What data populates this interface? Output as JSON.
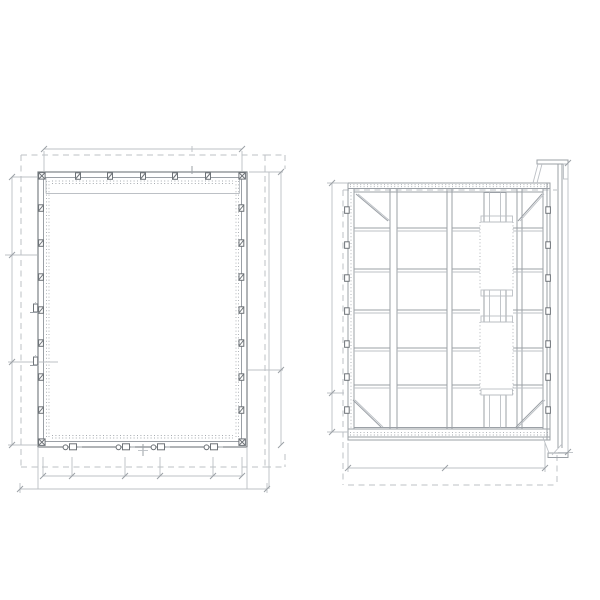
{
  "drawing": {
    "kind": "technical-panel-drawing",
    "views": [
      {
        "id": "front-elevation",
        "description": "panel front elevation with clearance box and dimension lines"
      },
      {
        "id": "rear-framing",
        "description": "panel rear framing view with stiffeners, braces and mounting rail"
      }
    ]
  },
  "colors": {
    "background": "#ffffff",
    "line_medium": "#9ba0a6",
    "line_dark": "#7d8287",
    "line_light": "#bcc0c5",
    "line_dashed": "#bdc1c5",
    "line_dotted": "#a6abb0",
    "hardware": "#6e7378"
  },
  "front": {
    "dashed": [
      [
        21,
        155,
        265,
        155
      ],
      [
        21,
        155,
        21,
        467
      ],
      [
        21,
        467,
        265,
        467
      ],
      [
        265,
        155,
        265,
        467
      ],
      [
        265,
        155,
        285,
        155
      ],
      [
        285,
        155,
        285,
        169
      ],
      [
        265,
        467,
        285,
        467
      ],
      [
        285,
        454,
        285,
        467
      ]
    ],
    "rects": [
      [
        38,
        172,
        209,
        275,
        "dk"
      ],
      [
        43.5,
        177.5,
        198,
        264,
        "ln"
      ]
    ],
    "lines": [
      [
        46,
        193.5,
        239.5,
        193.5,
        "lt"
      ],
      [
        46,
        178,
        46,
        193.5,
        "lt"
      ],
      [
        239.5,
        178,
        239.5,
        193.5,
        "lt"
      ],
      [
        192,
        166,
        192,
        174,
        "ln"
      ],
      [
        143,
        444,
        143,
        456,
        "ln"
      ],
      [
        138,
        450.5,
        148,
        450.5,
        "lt"
      ]
    ],
    "dotted": [
      [
        46.5,
        181,
        46.5,
        438
      ],
      [
        49,
        181,
        49,
        438
      ],
      [
        236,
        181,
        236,
        438
      ],
      [
        238.5,
        181,
        238.5,
        438
      ],
      [
        52,
        181,
        233,
        181
      ],
      [
        52,
        183.5,
        233,
        183.5
      ],
      [
        52,
        435.5,
        233,
        435.5
      ],
      [
        52,
        438,
        233,
        438
      ]
    ],
    "dim_lines": [
      [
        44,
        149,
        242,
        149
      ],
      [
        44,
        151,
        44,
        171
      ],
      [
        242,
        151,
        242,
        171
      ],
      [
        192,
        146,
        192,
        152
      ],
      [
        12,
        177,
        12,
        445
      ],
      [
        12,
        177,
        37,
        177
      ],
      [
        5,
        255,
        37,
        255
      ],
      [
        8,
        362,
        58,
        362
      ],
      [
        8,
        445,
        37,
        445
      ],
      [
        281,
        172,
        281,
        445
      ],
      [
        249,
        172,
        283,
        172
      ],
      [
        248,
        370,
        283,
        370
      ],
      [
        269,
        172,
        269,
        489
      ],
      [
        43,
        476,
        242,
        476
      ],
      [
        20,
        489,
        267,
        489
      ],
      [
        38,
        447,
        38,
        489
      ],
      [
        247,
        447,
        247,
        489
      ],
      [
        20,
        483,
        20,
        493
      ],
      [
        267,
        483,
        267,
        493
      ]
    ],
    "row1_ticks_x": [
      43,
      72,
      125,
      160,
      213,
      242
    ],
    "row1_tick_y": [
      457,
      476
    ],
    "slashes": [
      [
        44,
        149
      ],
      [
        242,
        149
      ],
      [
        12,
        177
      ],
      [
        12,
        255
      ],
      [
        12,
        362
      ],
      [
        12,
        445
      ],
      [
        281,
        172
      ],
      [
        281,
        370
      ],
      [
        281,
        445
      ],
      [
        20,
        489
      ],
      [
        267,
        489
      ]
    ],
    "top_clips_x": [
      78,
      110,
      143,
      175,
      208
    ],
    "side_clips_y": [
      208,
      243,
      277,
      310,
      343,
      377,
      410
    ],
    "corner_clips": [
      [
        38.6,
        172.6
      ],
      [
        238.9,
        172.6
      ],
      [
        38.6,
        438.9
      ],
      [
        238.9,
        438.9
      ]
    ],
    "hardware_x": [
      72,
      125,
      160,
      213
    ],
    "latches_y": [
      304,
      357
    ]
  },
  "side": {
    "dashed": [
      [
        343,
        190,
        557,
        190
      ],
      [
        343,
        190,
        343,
        485
      ],
      [
        348,
        485,
        557,
        485
      ],
      [
        557,
        455,
        557,
        485
      ]
    ],
    "rects": [
      [
        348,
        183,
        202,
        257,
        "ln"
      ],
      [
        484,
        192.5,
        22,
        29.5,
        "ln"
      ],
      [
        484,
        290,
        22,
        32,
        "ln"
      ],
      [
        484,
        395,
        22,
        32.5,
        "ln"
      ],
      [
        481,
        216,
        31.5,
        6,
        "lt"
      ],
      [
        481,
        290,
        31.5,
        6,
        "lt"
      ],
      [
        481,
        316,
        31.5,
        6,
        "lt"
      ],
      [
        481,
        389,
        31.5,
        6,
        "lt"
      ],
      [
        537,
        160,
        31,
        4,
        "ln"
      ],
      [
        563.5,
        164,
        4.5,
        15,
        "lt"
      ],
      [
        548,
        453,
        20,
        4.5,
        "ln"
      ]
    ],
    "lines": [
      [
        348,
        188.5,
        550,
        188.5,
        "ln"
      ],
      [
        348,
        429,
        550,
        429,
        "ln"
      ],
      [
        348,
        437,
        550,
        437,
        "ln"
      ],
      [
        354,
        192,
        543,
        192,
        "ln"
      ],
      [
        354,
        427.5,
        543,
        427.5,
        "ln"
      ],
      [
        354,
        188.5,
        354,
        429,
        "ln"
      ],
      [
        543,
        188.5,
        543,
        429,
        "ln"
      ],
      [
        547,
        183,
        547,
        440,
        "ln"
      ],
      [
        390,
        188.5,
        390,
        429,
        "ln"
      ],
      [
        397,
        188.5,
        397,
        429,
        "ln"
      ],
      [
        447,
        188.5,
        447,
        429,
        "ln"
      ],
      [
        452,
        188.5,
        452,
        429,
        "ln"
      ],
      [
        517,
        188.5,
        517,
        429,
        "ln"
      ],
      [
        522,
        188.5,
        522,
        429,
        "ln"
      ],
      [
        489.5,
        192.5,
        489.5,
        222,
        "lt"
      ],
      [
        500.5,
        192.5,
        500.5,
        222,
        "lt"
      ],
      [
        489.5,
        290,
        489.5,
        322,
        "lt"
      ],
      [
        500.5,
        290,
        500.5,
        322,
        "lt"
      ],
      [
        489.5,
        395,
        489.5,
        427.5,
        "lt"
      ],
      [
        500.5,
        395,
        500.5,
        427.5,
        "lt"
      ],
      [
        558,
        164,
        558,
        448,
        "ln"
      ],
      [
        562,
        164,
        562,
        448,
        "ln"
      ],
      [
        533,
        183,
        538,
        164,
        "lt"
      ],
      [
        537,
        183,
        542,
        164,
        "lt"
      ],
      [
        543,
        437.5,
        549,
        453,
        "lt"
      ],
      [
        562,
        444,
        552,
        455,
        "lt"
      ]
    ],
    "dotted": [
      [
        350,
        184.7,
        548,
        184.7
      ],
      [
        350,
        186.7,
        548,
        186.7
      ],
      [
        350,
        432.6,
        548,
        432.6
      ],
      [
        350,
        435,
        548,
        435
      ],
      [
        351,
        192,
        351,
        427.5
      ],
      [
        480,
        222,
        480,
        290
      ],
      [
        513,
        222,
        513,
        290
      ],
      [
        480,
        322,
        480,
        395
      ],
      [
        513,
        322,
        513,
        395
      ]
    ],
    "rails_y": [
      228,
      269,
      310,
      348,
      385
    ],
    "rail_spans": [
      [
        354,
        390
      ],
      [
        397,
        447
      ],
      [
        452,
        480
      ],
      [
        513,
        543
      ]
    ],
    "braces": [
      [
        356,
        194,
        388,
        221
      ],
      [
        542,
        194,
        518,
        221
      ],
      [
        353,
        400,
        381,
        427
      ],
      [
        543,
        400,
        516,
        427
      ]
    ],
    "clip_left_x": 344.6,
    "clip_right_x": 545.8,
    "clips_y": [
      210,
      245,
      278,
      311,
      344,
      377,
      410
    ],
    "dim_lines": [
      [
        332,
        183,
        332,
        432
      ],
      [
        327,
        183,
        348,
        183
      ],
      [
        327,
        432,
        348,
        432
      ],
      [
        327,
        393,
        344,
        393
      ],
      [
        568,
        163,
        568,
        452
      ],
      [
        558,
        452.5,
        573,
        452.5
      ],
      [
        348,
        468,
        545,
        468
      ],
      [
        348,
        443,
        348,
        472
      ],
      [
        545,
        443,
        545,
        472
      ]
    ],
    "slashes": [
      [
        332,
        183
      ],
      [
        332,
        393
      ],
      [
        332,
        432
      ],
      [
        568,
        163
      ],
      [
        568,
        452
      ],
      [
        348,
        468
      ],
      [
        545,
        468
      ],
      [
        445,
        468
      ]
    ]
  }
}
